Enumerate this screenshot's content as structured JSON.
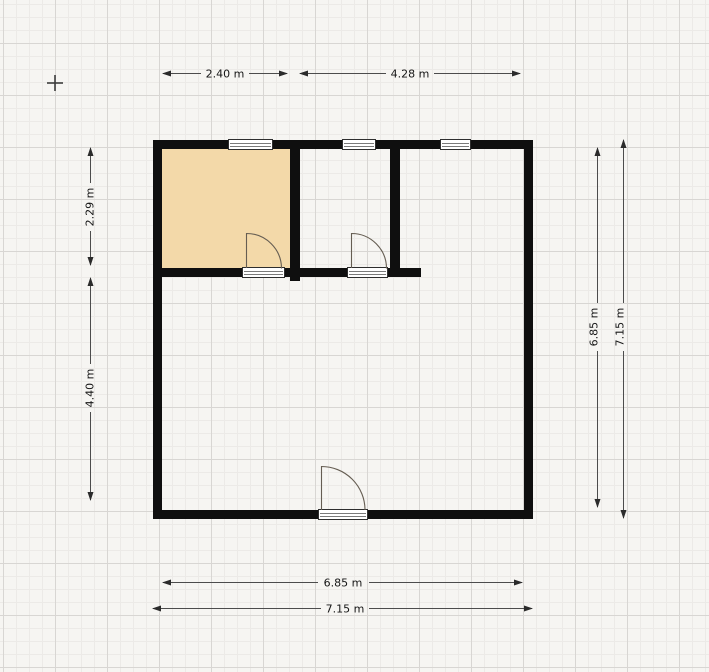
{
  "canvas": {
    "type": "floor-plan-editor-canvas",
    "unit": "m",
    "background_color": "#f6f5f2",
    "grid_minor_color": "#eceae7",
    "grid_major_color": "#d8d6d3",
    "wall_color": "#0f0f0f",
    "room_fill_color": "#f3d9a9"
  },
  "dimensions": {
    "top": [
      {
        "label": "2.40 m"
      },
      {
        "label": "4.28 m"
      }
    ],
    "left": [
      {
        "label": "2.29 m"
      },
      {
        "label": "4.40 m"
      }
    ],
    "right": [
      {
        "label": "6.85 m"
      },
      {
        "label": "7.15 m"
      }
    ],
    "bottom": [
      {
        "label": "6.85 m"
      },
      {
        "label": "7.15 m"
      }
    ]
  },
  "plan": {
    "rooms": [
      {
        "name": "top-left-room",
        "filled": true
      },
      {
        "name": "top-middle-room",
        "filled": false
      },
      {
        "name": "top-right-room",
        "filled": false
      },
      {
        "name": "main-room",
        "filled": false
      }
    ],
    "window_count": 3,
    "door_count": 3
  },
  "icons": {
    "crosshair": "plus-crosshair-cursor"
  }
}
